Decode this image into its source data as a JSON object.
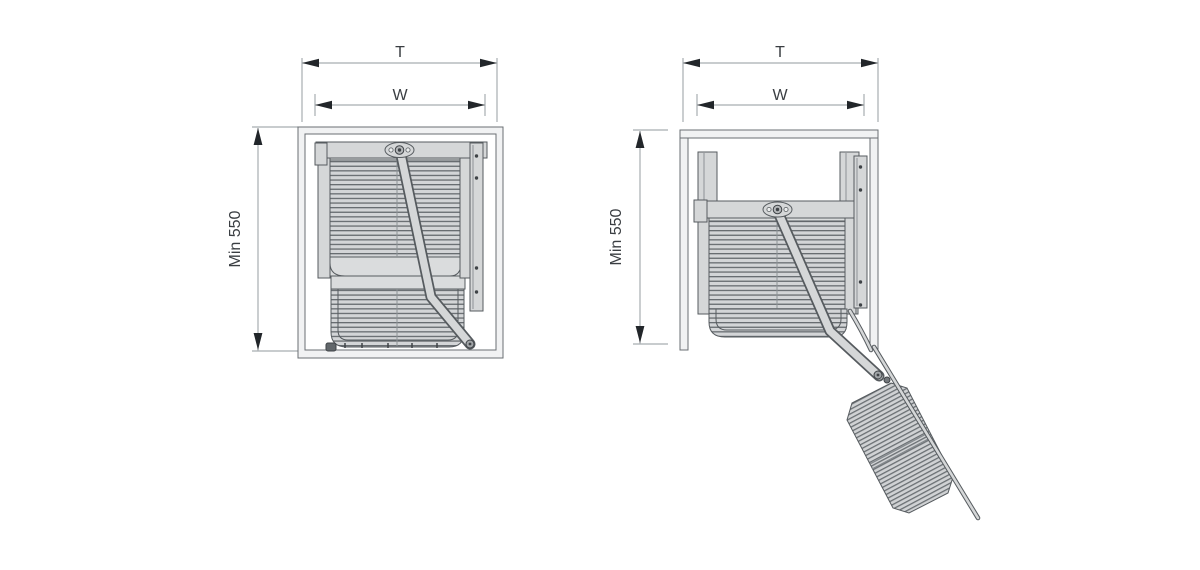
{
  "colors": {
    "background": "#ffffff",
    "outline": "#565b5f",
    "metal_fill": "#d5d7d8",
    "cabinet_panel_fill": "#f1f2f3",
    "dimension_line": "#a8adb1",
    "dimension_arrow": "#22262a",
    "dimension_text": "#3a3e42"
  },
  "diagrams": {
    "left": {
      "labels": {
        "total_width": "T",
        "inner_width": "W",
        "min_height": "Min 550"
      }
    },
    "right": {
      "labels": {
        "total_width": "T",
        "inner_width": "W",
        "min_height": "Min 550"
      }
    }
  }
}
